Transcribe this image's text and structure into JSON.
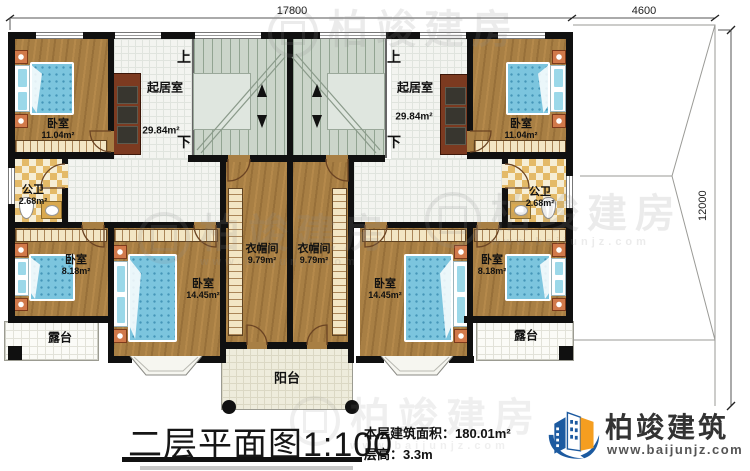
{
  "plan": {
    "dims": {
      "width_main": "17800",
      "width_right": "4600",
      "height_right": "12000"
    },
    "stairs": {
      "up": "上",
      "down": "下"
    },
    "rooms": {
      "bedroom_tl": {
        "name": "卧室",
        "area": "11.04m²"
      },
      "bedroom_tr": {
        "name": "卧室",
        "area": "11.04m²"
      },
      "living_l": {
        "name": "起居室",
        "area": "29.84m²"
      },
      "living_r": {
        "name": "起居室",
        "area": "29.84m²"
      },
      "bath_l": {
        "name": "公卫",
        "area": "2.68m²"
      },
      "bath_r": {
        "name": "公卫",
        "area": "2.68m²"
      },
      "bedroom_bl": {
        "name": "卧室",
        "area": "8.18m²"
      },
      "bedroom_br": {
        "name": "卧室",
        "area": "8.18m²"
      },
      "bedroom_ml": {
        "name": "卧室",
        "area": "14.45m²"
      },
      "bedroom_mr": {
        "name": "卧室",
        "area": "14.45m²"
      },
      "closet_l": {
        "name": "衣帽间",
        "area": "9.79m²"
      },
      "closet_r": {
        "name": "衣帽间",
        "area": "9.79m²"
      },
      "terrace_l": {
        "name": "露台"
      },
      "terrace_r": {
        "name": "露台"
      },
      "balcony": {
        "name": "阳台"
      }
    }
  },
  "titleblock": {
    "title": "二层平面图1:100",
    "area_label": "本层建筑面积：",
    "area_value": "180.01m²",
    "floor_height_label": "层高：",
    "floor_height_value": "3.3m"
  },
  "brand": {
    "name": "柏竣建筑",
    "url": "www.baijunjz.com"
  },
  "watermark": {
    "text": "柏竣建房",
    "url": "www.baijunjz.com"
  },
  "colors": {
    "accent_blue": "#1c5aa0",
    "accent_orange": "#f59e20",
    "wall": "#101010",
    "wood": "#a87f44"
  }
}
